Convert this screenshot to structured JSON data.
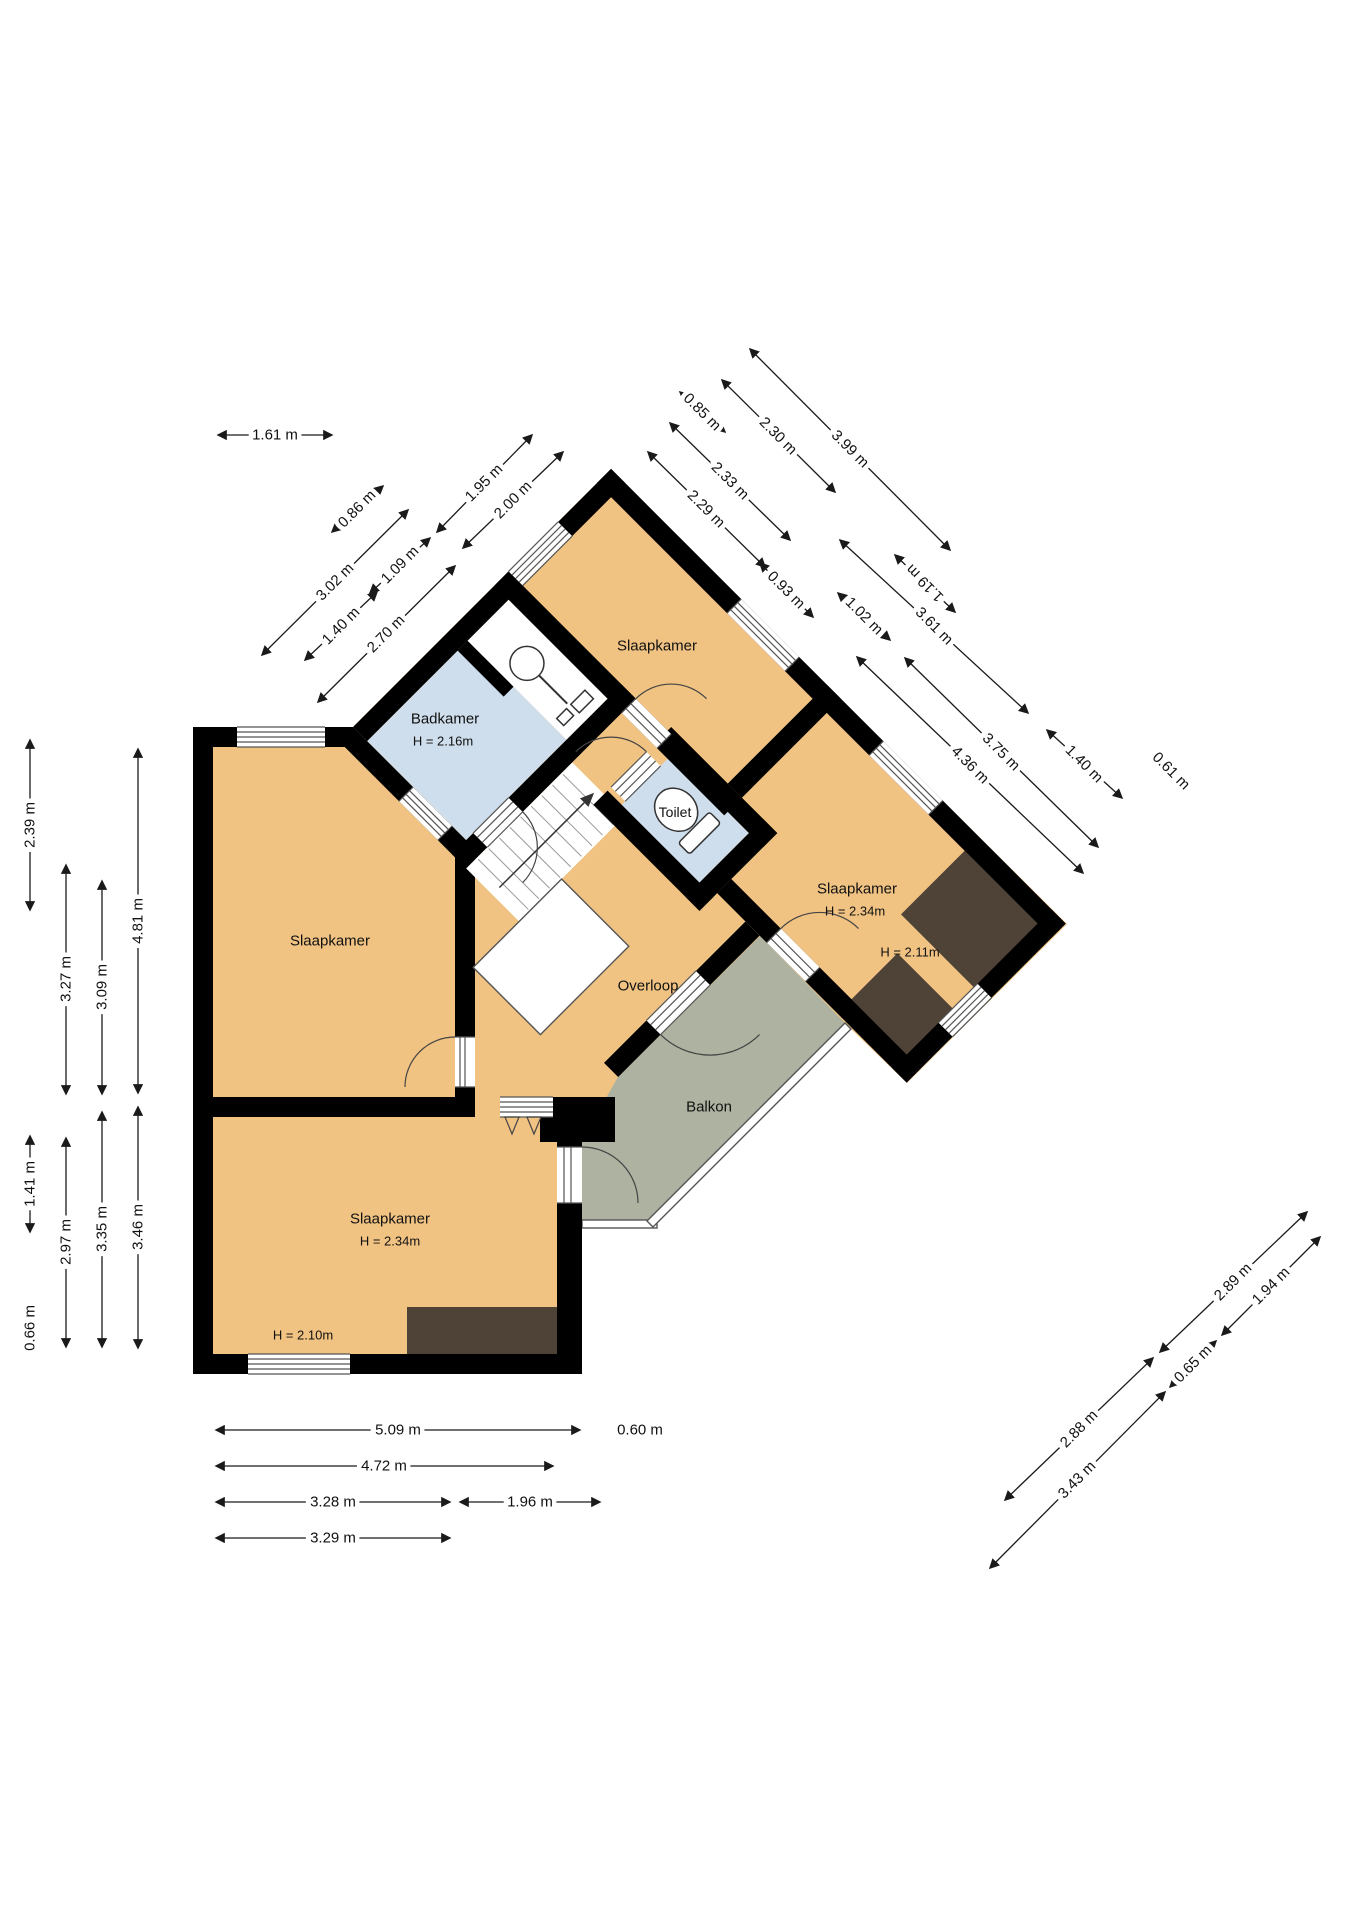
{
  "title": "floor-plan",
  "rooms": {
    "bathroom": {
      "name": "Badkamer",
      "height": "H = 2.16m"
    },
    "bedroom_top": {
      "name": "Slaapkamer"
    },
    "toilet": {
      "name": "Toilet"
    },
    "bedroom_right": {
      "name": "Slaapkamer",
      "height": "H = 2.34m",
      "height2": "H = 2.11m"
    },
    "landing": {
      "name": "Overloop"
    },
    "balcony": {
      "name": "Balkon"
    },
    "bedroom_left": {
      "name": "Slaapkamer"
    },
    "bedroom_bottom": {
      "name": "Slaapkamer",
      "height": "H = 2.34m",
      "height2": "H = 2.10m"
    }
  },
  "dimensions": {
    "top_left_horizontal": [
      "1.61 m"
    ],
    "upper_diag_up": [
      "0.86 m",
      "3.02 m",
      "1.40 m",
      "1.09 m",
      "1.95 m",
      "2.00 m",
      "2.70 m"
    ],
    "upper_diag_down": [
      "0.85 m",
      "2.30 m",
      "3.99 m",
      "2.33 m",
      "2.29 m",
      "0.93 m",
      "1.02 m",
      "1.19 m",
      "3.61 m",
      "3.75 m",
      "4.36 m",
      "1.40 m",
      "0.61 m"
    ],
    "left_vertical": [
      "2.39 m",
      "3.27 m",
      "3.09 m",
      "4.81 m",
      "1.41 m",
      "2.97 m",
      "3.35 m",
      "3.46 m",
      "0.66 m"
    ],
    "bottom_horizontal": [
      "5.09 m",
      "0.60 m",
      "4.72 m",
      "3.28 m",
      "1.96 m",
      "3.29 m"
    ],
    "bottom_right_diag": [
      "2.89 m",
      "1.94 m",
      "2.88 m",
      "0.65 m",
      "3.43 m"
    ]
  },
  "colors": {
    "room_fill": "#f1c383",
    "wet_room_fill": "#cfdeec",
    "balcony_fill": "#adb2a1",
    "low_ceiling_fill": "#4f4337",
    "wall": "#000000",
    "dimension": "#1a1a1a"
  }
}
